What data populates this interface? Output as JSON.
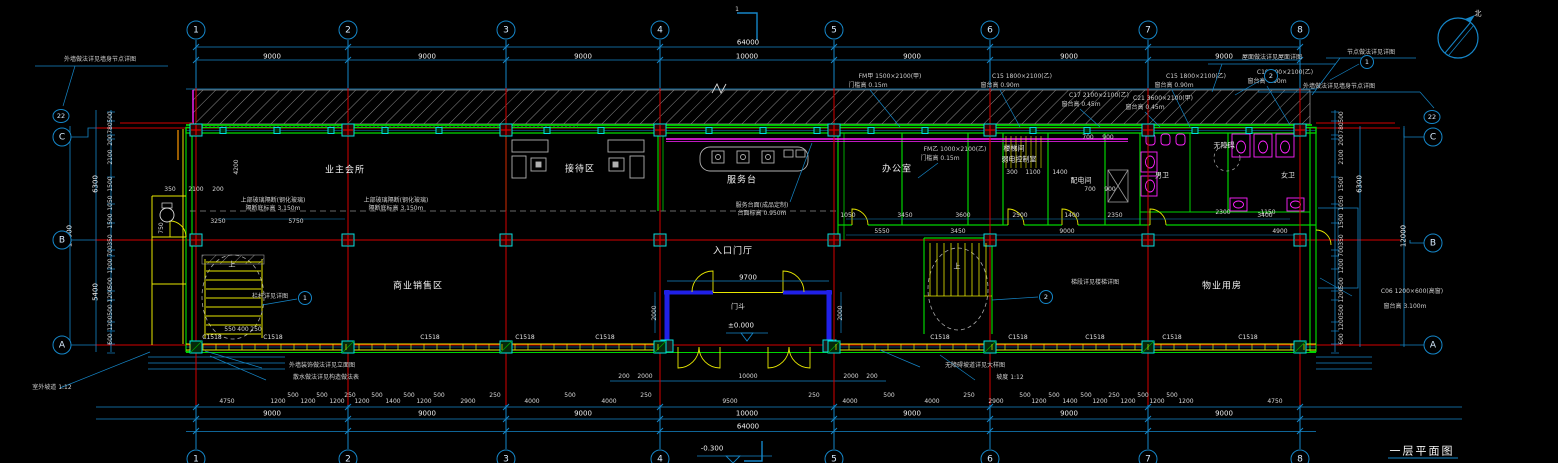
{
  "canvas": {
    "width": 1558,
    "height": 463,
    "background": "#000000"
  },
  "colors": {
    "grid_red": "#d40000",
    "wall_green": "#00d400",
    "dim_cyan": "#1586c8",
    "accent_yellow": "#e8e800",
    "fixture_magenta": "#ff22ff",
    "column_teal": "#00e0e0",
    "hatch_gray": "#8a8a8a",
    "text": "#e8e8e8",
    "entrance_blue": "#2020e8"
  },
  "grid": {
    "cols": [
      {
        "label": "1",
        "x": 196
      },
      {
        "label": "2",
        "x": 348
      },
      {
        "label": "3",
        "x": 506
      },
      {
        "label": "4",
        "x": 660
      },
      {
        "label": "5",
        "x": 834
      },
      {
        "label": "6",
        "x": 990
      },
      {
        "label": "7",
        "x": 1148
      },
      {
        "label": "8",
        "x": 1300
      }
    ],
    "row_labels": [
      "C",
      "B",
      "A"
    ]
  },
  "letter_bubbles": [
    {
      "label": "C",
      "x": 62,
      "y": 137
    },
    {
      "label": "B",
      "x": 62,
      "y": 240
    },
    {
      "label": "A",
      "x": 62,
      "y": 345
    },
    {
      "label": "C",
      "x": 1433,
      "y": 137
    },
    {
      "label": "B",
      "x": 1433,
      "y": 243
    },
    {
      "label": "A",
      "x": 1433,
      "y": 345
    }
  ],
  "wall_callouts": [
    {
      "label": "22",
      "x": 61,
      "y": 116
    },
    {
      "label": "22",
      "x": 1432,
      "y": 117
    }
  ],
  "detail_bubbles": [
    {
      "label": "1",
      "x": 305,
      "y": 298
    },
    {
      "label": "2",
      "x": 1046,
      "y": 297
    },
    {
      "label": "2",
      "x": 1271,
      "y": 76
    },
    {
      "label": "1",
      "x": 1367,
      "y": 62
    }
  ],
  "title": {
    "text": "一层平面图"
  },
  "levels": {
    "entrance": "±0.000",
    "exterior": "-0.300"
  },
  "texts": [
    {
      "x": 272,
      "y": 57,
      "t": "9000",
      "c": "d"
    },
    {
      "x": 427,
      "y": 57,
      "t": "9000",
      "c": "d"
    },
    {
      "x": 583,
      "y": 57,
      "t": "9000",
      "c": "d"
    },
    {
      "x": 747,
      "y": 57,
      "t": "10000",
      "c": "d"
    },
    {
      "x": 912,
      "y": 57,
      "t": "9000",
      "c": "d"
    },
    {
      "x": 1069,
      "y": 57,
      "t": "9000",
      "c": "d"
    },
    {
      "x": 1224,
      "y": 57,
      "t": "9000",
      "c": "d"
    },
    {
      "x": 748,
      "y": 43,
      "t": "64000",
      "c": "d"
    },
    {
      "x": 272,
      "y": 414,
      "t": "9000",
      "c": "d"
    },
    {
      "x": 427,
      "y": 414,
      "t": "9000",
      "c": "d"
    },
    {
      "x": 583,
      "y": 414,
      "t": "9000",
      "c": "d"
    },
    {
      "x": 747,
      "y": 414,
      "t": "10000",
      "c": "d"
    },
    {
      "x": 912,
      "y": 414,
      "t": "9000",
      "c": "d"
    },
    {
      "x": 1069,
      "y": 414,
      "t": "9000",
      "c": "d"
    },
    {
      "x": 1224,
      "y": 414,
      "t": "9000",
      "c": "d"
    },
    {
      "x": 748,
      "y": 427,
      "t": "64000",
      "c": "d"
    },
    {
      "x": 227,
      "y": 402,
      "t": "4750",
      "c": "s"
    },
    {
      "x": 278,
      "y": 402,
      "t": "1200",
      "c": "s"
    },
    {
      "x": 293,
      "y": 396,
      "t": "500",
      "c": "s"
    },
    {
      "x": 308,
      "y": 402,
      "t": "1200",
      "c": "s"
    },
    {
      "x": 322,
      "y": 396,
      "t": "500",
      "c": "s"
    },
    {
      "x": 337,
      "y": 402,
      "t": "1200",
      "c": "s"
    },
    {
      "x": 350,
      "y": 396,
      "t": "250",
      "c": "s"
    },
    {
      "x": 362,
      "y": 402,
      "t": "1200",
      "c": "s"
    },
    {
      "x": 377,
      "y": 396,
      "t": "500",
      "c": "s"
    },
    {
      "x": 393,
      "y": 402,
      "t": "1400",
      "c": "s"
    },
    {
      "x": 409,
      "y": 396,
      "t": "500",
      "c": "s"
    },
    {
      "x": 424,
      "y": 402,
      "t": "1200",
      "c": "s"
    },
    {
      "x": 439,
      "y": 396,
      "t": "500",
      "c": "s"
    },
    {
      "x": 468,
      "y": 402,
      "t": "2900",
      "c": "s"
    },
    {
      "x": 495,
      "y": 396,
      "t": "250",
      "c": "s"
    },
    {
      "x": 532,
      "y": 402,
      "t": "4000",
      "c": "s"
    },
    {
      "x": 570,
      "y": 396,
      "t": "500",
      "c": "s"
    },
    {
      "x": 609,
      "y": 402,
      "t": "4000",
      "c": "s"
    },
    {
      "x": 646,
      "y": 396,
      "t": "250",
      "c": "s"
    },
    {
      "x": 730,
      "y": 402,
      "t": "9500",
      "c": "s"
    },
    {
      "x": 814,
      "y": 396,
      "t": "250",
      "c": "s"
    },
    {
      "x": 850,
      "y": 402,
      "t": "4000",
      "c": "s"
    },
    {
      "x": 889,
      "y": 396,
      "t": "500",
      "c": "s"
    },
    {
      "x": 932,
      "y": 402,
      "t": "4000",
      "c": "s"
    },
    {
      "x": 969,
      "y": 396,
      "t": "250",
      "c": "s"
    },
    {
      "x": 996,
      "y": 402,
      "t": "2900",
      "c": "s"
    },
    {
      "x": 1025,
      "y": 396,
      "t": "500",
      "c": "s"
    },
    {
      "x": 1039,
      "y": 402,
      "t": "1200",
      "c": "s"
    },
    {
      "x": 1054,
      "y": 396,
      "t": "500",
      "c": "s"
    },
    {
      "x": 1070,
      "y": 402,
      "t": "1400",
      "c": "s"
    },
    {
      "x": 1086,
      "y": 396,
      "t": "500",
      "c": "s"
    },
    {
      "x": 1100,
      "y": 402,
      "t": "1200",
      "c": "s"
    },
    {
      "x": 1114,
      "y": 396,
      "t": "250",
      "c": "s"
    },
    {
      "x": 1128,
      "y": 402,
      "t": "1200",
      "c": "s"
    },
    {
      "x": 1143,
      "y": 396,
      "t": "500",
      "c": "s"
    },
    {
      "x": 1157,
      "y": 402,
      "t": "1200",
      "c": "s"
    },
    {
      "x": 1172,
      "y": 396,
      "t": "500",
      "c": "s"
    },
    {
      "x": 1186,
      "y": 402,
      "t": "1200",
      "c": "s"
    },
    {
      "x": 1275,
      "y": 402,
      "t": "4750",
      "c": "s"
    },
    {
      "x": 624,
      "y": 377,
      "t": "200",
      "c": "s"
    },
    {
      "x": 645,
      "y": 377,
      "t": "2000",
      "c": "s"
    },
    {
      "x": 748,
      "y": 377,
      "t": "10000",
      "c": "s"
    },
    {
      "x": 851,
      "y": 377,
      "t": "2000",
      "c": "s"
    },
    {
      "x": 872,
      "y": 377,
      "t": "200",
      "c": "s"
    },
    {
      "x": 748,
      "y": 278,
      "t": "9700",
      "c": "d"
    },
    {
      "x": 655,
      "y": 313,
      "t": "2000",
      "c": "s",
      "r": 1
    },
    {
      "x": 841,
      "y": 313,
      "t": "2000",
      "c": "s",
      "r": 1
    },
    {
      "x": 111,
      "y": 117,
      "t": "500",
      "c": "s",
      "r": 1
    },
    {
      "x": 111,
      "y": 128,
      "t": "780",
      "c": "s",
      "r": 1
    },
    {
      "x": 111,
      "y": 140,
      "t": "200",
      "c": "s",
      "r": 1
    },
    {
      "x": 111,
      "y": 157,
      "t": "2100",
      "c": "s",
      "r": 1
    },
    {
      "x": 111,
      "y": 184,
      "t": "1500",
      "c": "s",
      "r": 1
    },
    {
      "x": 111,
      "y": 203,
      "t": "1050",
      "c": "s",
      "r": 1
    },
    {
      "x": 111,
      "y": 221,
      "t": "1500",
      "c": "s",
      "r": 1
    },
    {
      "x": 111,
      "y": 240,
      "t": "350",
      "c": "s",
      "r": 1
    },
    {
      "x": 111,
      "y": 251,
      "t": "700",
      "c": "s",
      "r": 1
    },
    {
      "x": 111,
      "y": 266,
      "t": "1200",
      "c": "s",
      "r": 1
    },
    {
      "x": 111,
      "y": 283,
      "t": "500",
      "c": "s",
      "r": 1
    },
    {
      "x": 111,
      "y": 295,
      "t": "1200",
      "c": "s",
      "r": 1
    },
    {
      "x": 111,
      "y": 310,
      "t": "500",
      "c": "s",
      "r": 1
    },
    {
      "x": 111,
      "y": 323,
      "t": "1200",
      "c": "s",
      "r": 1
    },
    {
      "x": 111,
      "y": 339,
      "t": "600",
      "c": "s",
      "r": 1
    },
    {
      "x": 96,
      "y": 184,
      "t": "6300",
      "c": "d",
      "r": 1
    },
    {
      "x": 96,
      "y": 292,
      "t": "5400",
      "c": "d",
      "r": 1
    },
    {
      "x": 70,
      "y": 236,
      "t": "12000",
      "c": "d",
      "r": 1
    },
    {
      "x": 1342,
      "y": 117,
      "t": "500",
      "c": "s",
      "r": 1
    },
    {
      "x": 1342,
      "y": 128,
      "t": "780",
      "c": "s",
      "r": 1
    },
    {
      "x": 1342,
      "y": 140,
      "t": "200",
      "c": "s",
      "r": 1
    },
    {
      "x": 1342,
      "y": 157,
      "t": "2100",
      "c": "s",
      "r": 1
    },
    {
      "x": 1342,
      "y": 184,
      "t": "1500",
      "c": "s",
      "r": 1
    },
    {
      "x": 1342,
      "y": 203,
      "t": "1050",
      "c": "s",
      "r": 1
    },
    {
      "x": 1342,
      "y": 221,
      "t": "1500",
      "c": "s",
      "r": 1
    },
    {
      "x": 1342,
      "y": 240,
      "t": "350",
      "c": "s",
      "r": 1
    },
    {
      "x": 1342,
      "y": 251,
      "t": "700",
      "c": "s",
      "r": 1
    },
    {
      "x": 1342,
      "y": 266,
      "t": "1200",
      "c": "s",
      "r": 1
    },
    {
      "x": 1342,
      "y": 283,
      "t": "500",
      "c": "s",
      "r": 1
    },
    {
      "x": 1342,
      "y": 295,
      "t": "1200",
      "c": "s",
      "r": 1
    },
    {
      "x": 1342,
      "y": 310,
      "t": "500",
      "c": "s",
      "r": 1
    },
    {
      "x": 1342,
      "y": 323,
      "t": "1200",
      "c": "s",
      "r": 1
    },
    {
      "x": 1342,
      "y": 339,
      "t": "600",
      "c": "s",
      "r": 1
    },
    {
      "x": 1360,
      "y": 184,
      "t": "6300",
      "c": "d",
      "r": 1
    },
    {
      "x": 1404,
      "y": 236,
      "t": "12000",
      "c": "d",
      "r": 1
    },
    {
      "x": 218,
      "y": 222,
      "t": "3250",
      "c": "s"
    },
    {
      "x": 296,
      "y": 222,
      "t": "5750",
      "c": "s"
    },
    {
      "x": 237,
      "y": 167,
      "t": "4200",
      "c": "s",
      "r": 1
    },
    {
      "x": 170,
      "y": 190,
      "t": "350",
      "c": "s"
    },
    {
      "x": 196,
      "y": 190,
      "t": "2100",
      "c": "s"
    },
    {
      "x": 218,
      "y": 190,
      "t": "200",
      "c": "s"
    },
    {
      "x": 162,
      "y": 228,
      "t": "750",
      "c": "s",
      "r": 1
    },
    {
      "x": 230,
      "y": 330,
      "t": "550",
      "c": "s"
    },
    {
      "x": 243,
      "y": 330,
      "t": "400",
      "c": "s"
    },
    {
      "x": 256,
      "y": 330,
      "t": "250",
      "c": "s"
    },
    {
      "x": 848,
      "y": 216,
      "t": "1050",
      "c": "s"
    },
    {
      "x": 905,
      "y": 216,
      "t": "3450",
      "c": "s"
    },
    {
      "x": 963,
      "y": 216,
      "t": "3600",
      "c": "s"
    },
    {
      "x": 1020,
      "y": 216,
      "t": "2500",
      "c": "s"
    },
    {
      "x": 1072,
      "y": 216,
      "t": "1400",
      "c": "s"
    },
    {
      "x": 1115,
      "y": 216,
      "t": "2350",
      "c": "s"
    },
    {
      "x": 1265,
      "y": 216,
      "t": "3400",
      "c": "s"
    },
    {
      "x": 882,
      "y": 232,
      "t": "5550",
      "c": "s"
    },
    {
      "x": 958,
      "y": 232,
      "t": "3450",
      "c": "s"
    },
    {
      "x": 1067,
      "y": 232,
      "t": "9000",
      "c": "s"
    },
    {
      "x": 1280,
      "y": 232,
      "t": "4900",
      "c": "s"
    },
    {
      "x": 1012,
      "y": 173,
      "t": "300",
      "c": "s"
    },
    {
      "x": 1033,
      "y": 173,
      "t": "1100",
      "c": "s"
    },
    {
      "x": 1060,
      "y": 173,
      "t": "1400",
      "c": "s"
    },
    {
      "x": 1088,
      "y": 138,
      "t": "700",
      "c": "s"
    },
    {
      "x": 1108,
      "y": 138,
      "t": "900",
      "c": "s"
    },
    {
      "x": 1090,
      "y": 190,
      "t": "700",
      "c": "s"
    },
    {
      "x": 1110,
      "y": 190,
      "t": "900",
      "c": "s"
    },
    {
      "x": 1223,
      "y": 213,
      "t": "2300",
      "c": "s"
    },
    {
      "x": 1268,
      "y": 213,
      "t": "1150",
      "c": "s"
    },
    {
      "x": 345,
      "y": 171,
      "t": "业主会所",
      "c": "r",
      "n": "room-label"
    },
    {
      "x": 580,
      "y": 170,
      "t": "接待区",
      "c": "r",
      "n": "room-label"
    },
    {
      "x": 897,
      "y": 170,
      "t": "办公室",
      "c": "r",
      "n": "room-label"
    },
    {
      "x": 742,
      "y": 181,
      "t": "服务台",
      "c": "r",
      "n": "room-label"
    },
    {
      "x": 733,
      "y": 252,
      "t": "入口门厅",
      "c": "r",
      "n": "room-label"
    },
    {
      "x": 738,
      "y": 307,
      "t": "门斗",
      "c": "rs",
      "n": "room-label"
    },
    {
      "x": 418,
      "y": 287,
      "t": "商业销售区",
      "c": "r",
      "n": "room-label"
    },
    {
      "x": 1222,
      "y": 287,
      "t": "物业用房",
      "c": "r",
      "n": "room-label"
    },
    {
      "x": 1014,
      "y": 149,
      "t": "楼梯间",
      "c": "rs",
      "n": "room-label"
    },
    {
      "x": 1019,
      "y": 160,
      "t": "弱电控制室",
      "c": "rs",
      "n": "room-label"
    },
    {
      "x": 1081,
      "y": 181,
      "t": "配电间",
      "c": "rs",
      "n": "room-label"
    },
    {
      "x": 1162,
      "y": 176,
      "t": "男卫",
      "c": "rs",
      "n": "room-label"
    },
    {
      "x": 1288,
      "y": 176,
      "t": "女卫",
      "c": "rs",
      "n": "room-label"
    },
    {
      "x": 1224,
      "y": 146,
      "t": "无障碍",
      "c": "rs",
      "n": "room-label"
    },
    {
      "x": 232,
      "y": 265,
      "t": "上",
      "c": "rs",
      "n": "stair-direction"
    },
    {
      "x": 957,
      "y": 267,
      "t": "上",
      "c": "rs",
      "n": "stair-direction"
    },
    {
      "x": 100,
      "y": 60,
      "t": "外墙做法详见墙身节点详图",
      "c": "a"
    },
    {
      "x": 1339,
      "y": 87,
      "t": "外墙做法详见墙身节点详图",
      "c": "a"
    },
    {
      "x": 1272,
      "y": 58,
      "t": "屋面做法详见屋面详图",
      "c": "a"
    },
    {
      "x": 1371,
      "y": 53,
      "t": "节点做法详见详图",
      "c": "a"
    },
    {
      "x": 890,
      "y": 77,
      "t": "FM甲 1500×2100(甲)",
      "c": "a"
    },
    {
      "x": 868,
      "y": 86,
      "t": "门槛高 0.15m",
      "c": "a"
    },
    {
      "x": 1022,
      "y": 77,
      "t": "C15 1800×2100(乙)",
      "c": "a"
    },
    {
      "x": 1000,
      "y": 86,
      "t": "窗台高 0.90m",
      "c": "a"
    },
    {
      "x": 1099,
      "y": 96,
      "t": "C17 2100×2100(乙)",
      "c": "a"
    },
    {
      "x": 1081,
      "y": 105,
      "t": "窗台高 0.45m",
      "c": "a"
    },
    {
      "x": 1196,
      "y": 77,
      "t": "C15 1800×2100(乙)",
      "c": "a"
    },
    {
      "x": 1174,
      "y": 86,
      "t": "窗台高 0.90m",
      "c": "a"
    },
    {
      "x": 1285,
      "y": 73,
      "t": "C10 900×2100(乙)",
      "c": "a"
    },
    {
      "x": 1267,
      "y": 82,
      "t": "窗台高 0.90m",
      "c": "a"
    },
    {
      "x": 1163,
      "y": 99,
      "t": "C21 3600×2100(甲)",
      "c": "a"
    },
    {
      "x": 1145,
      "y": 108,
      "t": "窗台高 0.45m",
      "c": "a"
    },
    {
      "x": 955,
      "y": 150,
      "t": "FM乙 1000×2100(乙)",
      "c": "a"
    },
    {
      "x": 940,
      "y": 159,
      "t": "门槛高 0.15m",
      "c": "a"
    },
    {
      "x": 273,
      "y": 201,
      "t": "上部玻璃隔断(钢化玻璃)",
      "c": "a"
    },
    {
      "x": 273,
      "y": 209,
      "t": "隔断底标高 3.150m",
      "c": "a"
    },
    {
      "x": 396,
      "y": 201,
      "t": "上部玻璃隔断(钢化玻璃)",
      "c": "a"
    },
    {
      "x": 396,
      "y": 209,
      "t": "隔断底标高 3.150m",
      "c": "a"
    },
    {
      "x": 762,
      "y": 206,
      "t": "服务台面(成品定制)",
      "c": "a"
    },
    {
      "x": 762,
      "y": 214,
      "t": "台面标高 0.950m",
      "c": "a"
    },
    {
      "x": 322,
      "y": 366,
      "t": "外墙装饰做法详见立面图",
      "c": "a"
    },
    {
      "x": 326,
      "y": 378,
      "t": "散水做法详见构造做法表",
      "c": "a"
    },
    {
      "x": 975,
      "y": 366,
      "t": "无障碍坡道详见大样图",
      "c": "a"
    },
    {
      "x": 1010,
      "y": 378,
      "t": "坡度 1:12",
      "c": "a"
    },
    {
      "x": 1412,
      "y": 292,
      "t": "C06 1200×600(高窗)",
      "c": "a"
    },
    {
      "x": 1405,
      "y": 307,
      "t": "窗台高 3.100m",
      "c": "a"
    },
    {
      "x": 270,
      "y": 297,
      "t": "栏杆详见详图",
      "c": "a"
    },
    {
      "x": 1095,
      "y": 283,
      "t": "梯段详见楼梯详图",
      "c": "a"
    },
    {
      "x": 52,
      "y": 388,
      "t": "室外坡道 1:12",
      "c": "a"
    },
    {
      "x": 212,
      "y": 338,
      "t": "C1518",
      "c": "g",
      "n": "window-tag"
    },
    {
      "x": 273,
      "y": 338,
      "t": "C1518",
      "c": "g",
      "n": "window-tag"
    },
    {
      "x": 430,
      "y": 338,
      "t": "C1518",
      "c": "g",
      "n": "window-tag"
    },
    {
      "x": 525,
      "y": 338,
      "t": "C1518",
      "c": "g",
      "n": "window-tag"
    },
    {
      "x": 605,
      "y": 338,
      "t": "C1518",
      "c": "g",
      "n": "window-tag"
    },
    {
      "x": 940,
      "y": 338,
      "t": "C1518",
      "c": "g",
      "n": "window-tag"
    },
    {
      "x": 1018,
      "y": 338,
      "t": "C1518",
      "c": "g",
      "n": "window-tag"
    },
    {
      "x": 1095,
      "y": 338,
      "t": "C1518",
      "c": "g",
      "n": "window-tag"
    },
    {
      "x": 1172,
      "y": 338,
      "t": "C1518",
      "c": "g",
      "n": "window-tag"
    },
    {
      "x": 1248,
      "y": 338,
      "t": "C1518",
      "c": "g",
      "n": "window-tag"
    },
    {
      "x": 741,
      "y": 326,
      "t": "±0.000",
      "c": "l",
      "n": "level-marker"
    },
    {
      "x": 712,
      "y": 449,
      "t": "-0.300",
      "c": "l",
      "n": "level-marker"
    },
    {
      "x": 1422,
      "y": 451,
      "t": "一层平面图",
      "c": "ti",
      "n": "drawing-title"
    },
    {
      "x": 1478,
      "y": 14,
      "t": "北",
      "c": "rs",
      "n": "north-label"
    },
    {
      "x": 737,
      "y": 10,
      "t": "1",
      "c": "s",
      "n": "section-mark-label"
    }
  ]
}
